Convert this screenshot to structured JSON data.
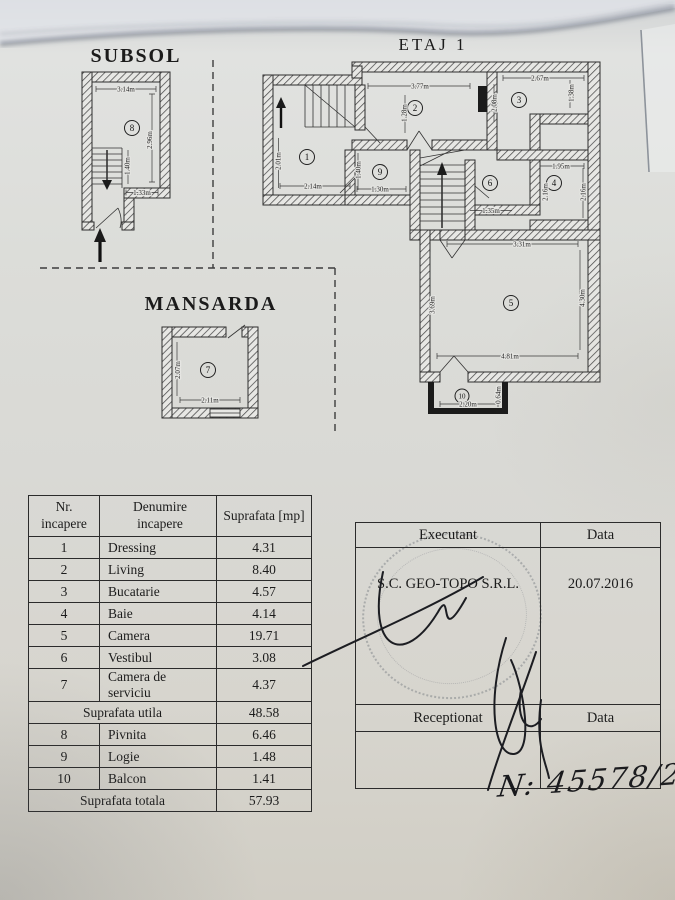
{
  "titles": {
    "subsol": "SUBSOL",
    "etaj1": "ETAJ 1",
    "mansarda": "MANSARDA"
  },
  "plans": {
    "subsol": {
      "room": "8",
      "dims": {
        "width": "3.14m",
        "height": "2.96m",
        "stairs_height": "1.40m",
        "inner_width": "1.33m"
      }
    },
    "etaj1": {
      "rooms": {
        "r1": "1",
        "r2": "2",
        "r3": "3",
        "r4": "4",
        "r5": "5",
        "r6": "6",
        "r9": "9",
        "r10": "10"
      },
      "dims": {
        "room2_width": "3.77m",
        "room2_height": "1.28m",
        "room3_width": "2.67m",
        "room3_right": "1.38m",
        "room3_left": "2.08m",
        "room1_width": "2.14m",
        "room1_height": "2.01m",
        "room9_width": "1.30m",
        "room9_height": "1.40m",
        "room4_width": "1.95m",
        "room4_right": "2.16m",
        "room4_left": "2.16m",
        "room6_width": "1.35m",
        "room5_top": "3.31m",
        "room5_bottom": "4.81m",
        "room5_right": "4.30m",
        "room5_left": "3.69m",
        "room10_width": "2.20m",
        "room10_depth": "0.64m"
      }
    },
    "mansarda": {
      "room": "7",
      "dims": {
        "width": "2.11m",
        "height": "2.07m"
      }
    }
  },
  "area_table": {
    "headers": {
      "nr": "Nr.\nincapere",
      "name": "Denumire\nincapere",
      "area": "Suprafata [mp]"
    },
    "rows": [
      [
        "1",
        "Dressing",
        "4.31"
      ],
      [
        "2",
        "Living",
        "8.40"
      ],
      [
        "3",
        "Bucatarie",
        "4.57"
      ],
      [
        "4",
        "Baie",
        "4.14"
      ],
      [
        "5",
        "Camera",
        "19.71"
      ],
      [
        "6",
        "Vestibul",
        "3.08"
      ],
      [
        "7",
        "Camera de serviciu",
        "4.37"
      ]
    ],
    "utila_label": "Suprafata utila",
    "utila_value": "48.58",
    "rows2": [
      [
        "8",
        "Pivnita",
        "6.46"
      ],
      [
        "9",
        "Logie",
        "1.48"
      ],
      [
        "10",
        "Balcon",
        "1.41"
      ]
    ],
    "totala_label": "Suprafata totala",
    "totala_value": "57.93"
  },
  "signoff": {
    "executant_label": "Executant",
    "executant_data_label": "Data",
    "company": "S.C. GEO-TOPO S.R.L.",
    "date": "20.07.2016",
    "receptionat_label": "Receptionat",
    "receptionat_data_label": "Data"
  },
  "annotation": {
    "registration": "N: 45578/2019"
  }
}
